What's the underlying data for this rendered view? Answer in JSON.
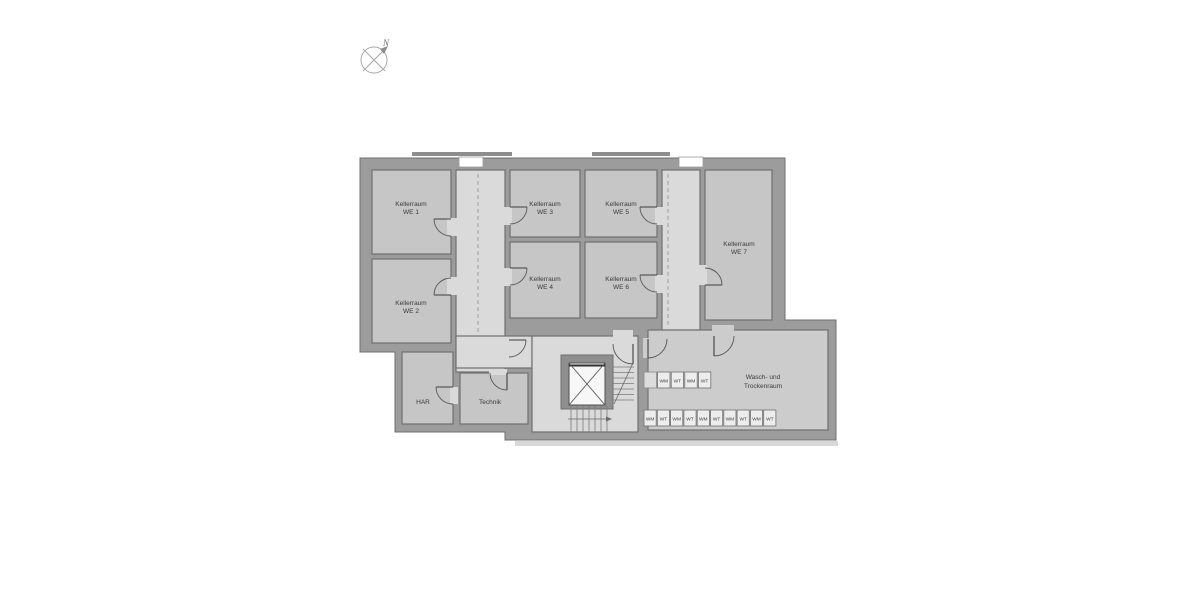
{
  "compass": {
    "north_label": "N"
  },
  "colors": {
    "wall": "#9c9c9c",
    "room_fill": "#c6c6c6",
    "corridor_fill": "#dadada",
    "washroom_fill": "#cccccc",
    "outline": "#6f6f6f",
    "label_text": "#3a3a3a",
    "elevator_shaft": "#f7f7f7",
    "machine_fill": "#ededed"
  },
  "rooms": {
    "we1": {
      "line1": "Kellerraum",
      "line2": "WE 1"
    },
    "we2": {
      "line1": "Kellerraum",
      "line2": "WE 2"
    },
    "we3": {
      "line1": "Kellerraum",
      "line2": "WE 3"
    },
    "we4": {
      "line1": "Kellerraum",
      "line2": "WE 4"
    },
    "we5": {
      "line1": "Kellerraum",
      "line2": "WE 5"
    },
    "we6": {
      "line1": "Kellerraum",
      "line2": "WE 6"
    },
    "we7": {
      "line1": "Kellerraum",
      "line2": "WE 7"
    },
    "har": {
      "line1": "HAR"
    },
    "technik": {
      "line1": "Technik"
    },
    "waschraum": {
      "line1": "Wasch- und",
      "line2": "Trockenraum"
    }
  },
  "machines": {
    "top_row": [
      "",
      "WM",
      "WT",
      "WM",
      "WT"
    ],
    "bottom_row": [
      "WM",
      "WT",
      "WM",
      "WT",
      "WM",
      "WT",
      "WM",
      "WT",
      "WM",
      "WT"
    ]
  }
}
